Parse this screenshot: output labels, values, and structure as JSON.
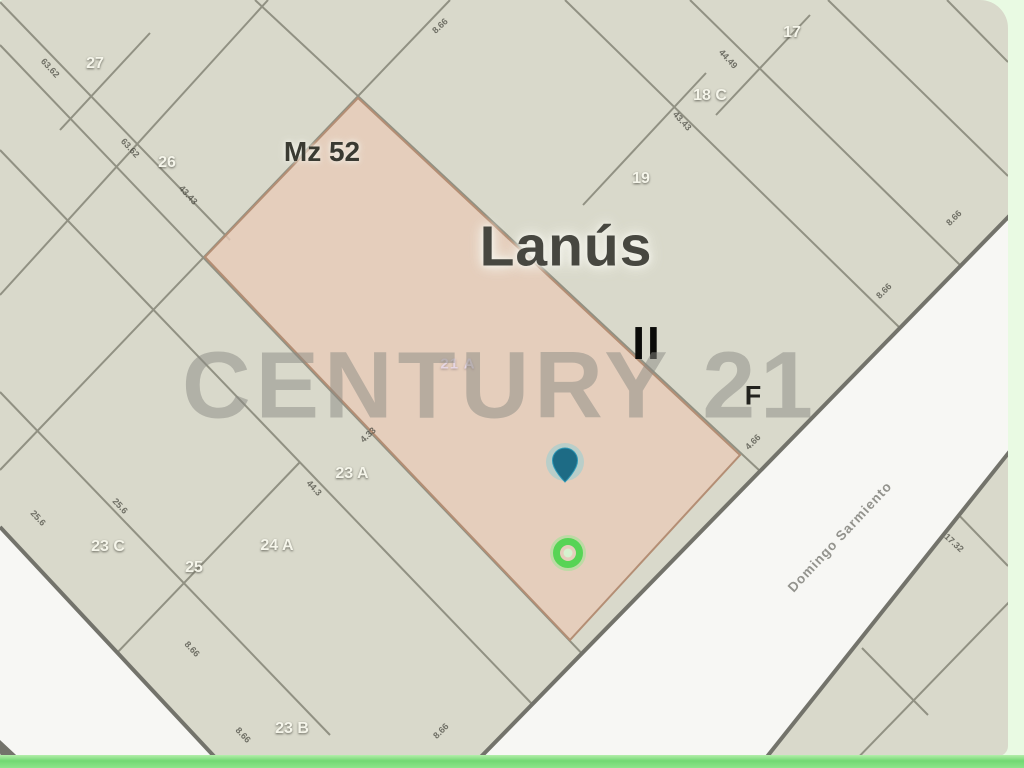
{
  "map": {
    "block_label": "Mz 52",
    "city_name": "Lanús",
    "zone_marker": "II",
    "section_marker": "F",
    "watermark_text": "CENTURY 21",
    "street_name": "Domingo Sarmiento",
    "highlighted_parcel_label": "21 A",
    "colors": {
      "page_bg": "#e9fae3",
      "map_bg": "#d9d9cb",
      "parcel_line": "#919183",
      "road_fill": "#f7f7f4",
      "road_edge": "#73736b",
      "highlight_fill": "rgba(231,203,184,0.8)",
      "highlight_stroke": "#b48e74",
      "pin_fill": "#1d6b85",
      "pin_glow": "#52cce8",
      "marker_green": "#57d455",
      "marker_green_halo": "#8ce889",
      "marker_green_center": "#d6f2cf",
      "bottom_bar_green": "#72d873",
      "watermark_color": "#8b8b84"
    },
    "parcel_labels": [
      {
        "text": "27",
        "x": 95,
        "y": 62
      },
      {
        "text": "26",
        "x": 167,
        "y": 161
      },
      {
        "text": "17",
        "x": 792,
        "y": 31
      },
      {
        "text": "18 C",
        "x": 710,
        "y": 94
      },
      {
        "text": "19",
        "x": 641,
        "y": 177
      },
      {
        "text": "23 A",
        "x": 352,
        "y": 472
      },
      {
        "text": "24 A",
        "x": 277,
        "y": 544
      },
      {
        "text": "23 C",
        "x": 108,
        "y": 545
      },
      {
        "text": "25",
        "x": 194,
        "y": 566
      },
      {
        "text": "23 B",
        "x": 292,
        "y": 727
      }
    ],
    "dimension_labels": [
      {
        "text": "63.62",
        "x": 48,
        "y": 70,
        "rot": 47
      },
      {
        "text": "63.62",
        "x": 128,
        "y": 150,
        "rot": 47
      },
      {
        "text": "43.43",
        "x": 186,
        "y": 197,
        "rot": 47
      },
      {
        "text": "8.66",
        "x": 442,
        "y": 28,
        "rot": -43
      },
      {
        "text": "44.3",
        "x": 312,
        "y": 490,
        "rot": 47
      },
      {
        "text": "4.33",
        "x": 370,
        "y": 437,
        "rot": -43
      },
      {
        "text": "44.49",
        "x": 726,
        "y": 61,
        "rot": 47
      },
      {
        "text": "43.43",
        "x": 680,
        "y": 123,
        "rot": 47
      },
      {
        "text": "8.66",
        "x": 956,
        "y": 220,
        "rot": -45
      },
      {
        "text": "8.66",
        "x": 886,
        "y": 293,
        "rot": -45
      },
      {
        "text": "4.66",
        "x": 755,
        "y": 444,
        "rot": -45
      },
      {
        "text": "17.32",
        "x": 952,
        "y": 545,
        "rot": 43
      },
      {
        "text": "8.66",
        "x": 190,
        "y": 651,
        "rot": 47
      },
      {
        "text": "8.66",
        "x": 241,
        "y": 737,
        "rot": 47
      },
      {
        "text": "8.66",
        "x": 443,
        "y": 733,
        "rot": -45
      },
      {
        "text": "25.6",
        "x": 36,
        "y": 520,
        "rot": 47
      },
      {
        "text": "25.6",
        "x": 118,
        "y": 508,
        "rot": 47
      }
    ],
    "geometry": {
      "parcel_lines": [
        [
          0,
          2,
          230,
          240
        ],
        [
          0,
          45,
          590,
          662
        ],
        [
          0,
          150,
          532,
          704
        ],
        [
          0,
          392,
          330,
          735
        ],
        [
          255,
          0,
          760,
          471
        ],
        [
          565,
          0,
          900,
          328
        ],
        [
          690,
          0,
          961,
          266
        ],
        [
          828,
          0,
          1008,
          176
        ],
        [
          947,
          0,
          1008,
          62
        ],
        [
          952,
          508,
          1008,
          566
        ],
        [
          862,
          648,
          928,
          715
        ],
        [
          0,
          295,
          268,
          0
        ],
        [
          60,
          130,
          150,
          33
        ],
        [
          0,
          470,
          450,
          0
        ],
        [
          115,
          655,
          300,
          462
        ],
        [
          583,
          205,
          706,
          73
        ],
        [
          716,
          115,
          810,
          15
        ],
        [
          848,
          768,
          1013,
          598
        ]
      ],
      "road_polygons": [
        "1020,205 470,768 760,768 1014,448",
        "0,527 225,768 0,768"
      ],
      "road_edges": [
        [
          1020,
          205,
          470,
          768
        ],
        [
          1014,
          446,
          758,
          768
        ],
        [
          0,
          527,
          225,
          768
        ]
      ],
      "corner_wedge": "0,740 30,768 0,768",
      "highlight_polygon": "358,98 740,455 570,640 205,257",
      "markers": {
        "pin": {
          "x": 565,
          "y": 462
        },
        "green_circle": {
          "x": 568,
          "y": 553
        }
      }
    }
  }
}
